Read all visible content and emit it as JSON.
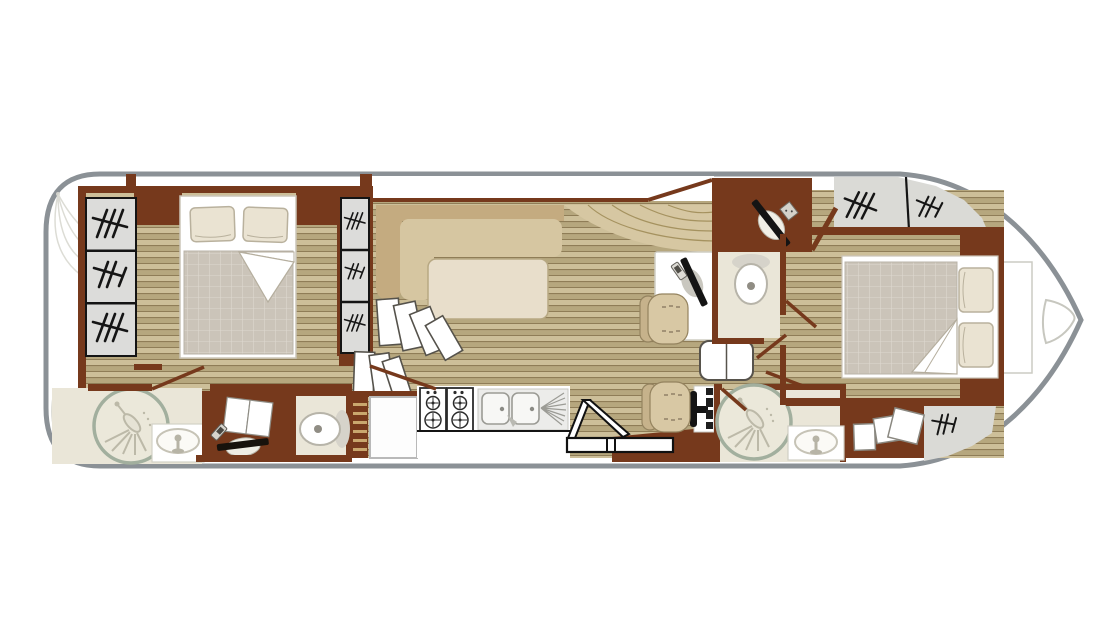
{
  "plan": {
    "title": "houseboat deck floor plan, bow to the right",
    "rooms": [
      {
        "name": "stern deck"
      },
      {
        "name": "aft cabin with double bed"
      },
      {
        "name": "aft bathroom with shower and washbasin"
      },
      {
        "name": "wardrobe with towels and vanity"
      },
      {
        "name": "aft toilet room"
      },
      {
        "name": "saloon with corner sofa and table"
      },
      {
        "name": "galley with gas hob, double sink and fridge"
      },
      {
        "name": "helm station with pilot seat and steering console"
      },
      {
        "name": "dressing table with seat"
      },
      {
        "name": "forward toilet room"
      },
      {
        "name": "forward shower room with washbasin"
      },
      {
        "name": "forward cabin with double bed"
      },
      {
        "name": "bow deck with anchor hatch"
      }
    ],
    "fixtures": [
      "double bed x2",
      "pillows x4",
      "quilted mattress x2",
      "shower x2",
      "pedestal washbasin x2",
      "toilet x2",
      "L-shaped sofa",
      "saloon table",
      "folding leaf table",
      "gas hob with 4 burners",
      "double sink with drainer",
      "fridge",
      "companionway steps x2",
      "folding ladder",
      "wall ladder",
      "steering wheel console",
      "armchair x2",
      "window x9"
    ],
    "colors": {
      "hull_outline": "#8b9196",
      "cabin_wall": "#76391c",
      "floor_plank_light": "#cdbf99",
      "floor_plank_dark": "#b6a77e",
      "plank_line": "#8f7d57",
      "window_pane": "#dcdcda",
      "window_glyph": "#151515",
      "bathroom_floor": "#eae6d8",
      "shower_ring": "#a2af9e",
      "sofa_back": "#c4ab80",
      "sofa_seat": "#d6c6a1",
      "saloon_table": "#e8decb",
      "bed_quilt": "#cbc4b9",
      "pillow": "#eae3d2",
      "deck_gray": "#dadad6"
    }
  }
}
